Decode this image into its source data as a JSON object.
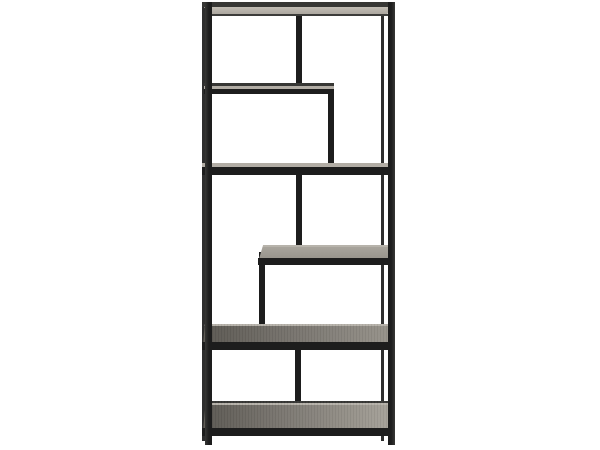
{
  "scene": {
    "type": "product-photo",
    "object": "bookcase",
    "description": "Tall narrow etagere bookcase with a black metal frame, asymmetric staggered shelves and offset vertical dividers, shown on a plain white background. Lower shelf tops are gray-brown wood; the top shelf shows a light underside."
  },
  "colors": {
    "background": "#ffffff",
    "frame": "#1d1d1d",
    "frame_soft": "#373735",
    "back_leg": "#2e2e2e",
    "underside_light": "#c2bdb4",
    "underside_shadow": "#a9a49c",
    "sliver": "#b2ada5",
    "edge_line": "#3c3c3a",
    "highlight": "#b7b3ab",
    "wood_pale": "#a8a49c",
    "wood_light": "#98948c",
    "wood_mid": "#7a7670",
    "wood_dark": "#5b5852"
  }
}
